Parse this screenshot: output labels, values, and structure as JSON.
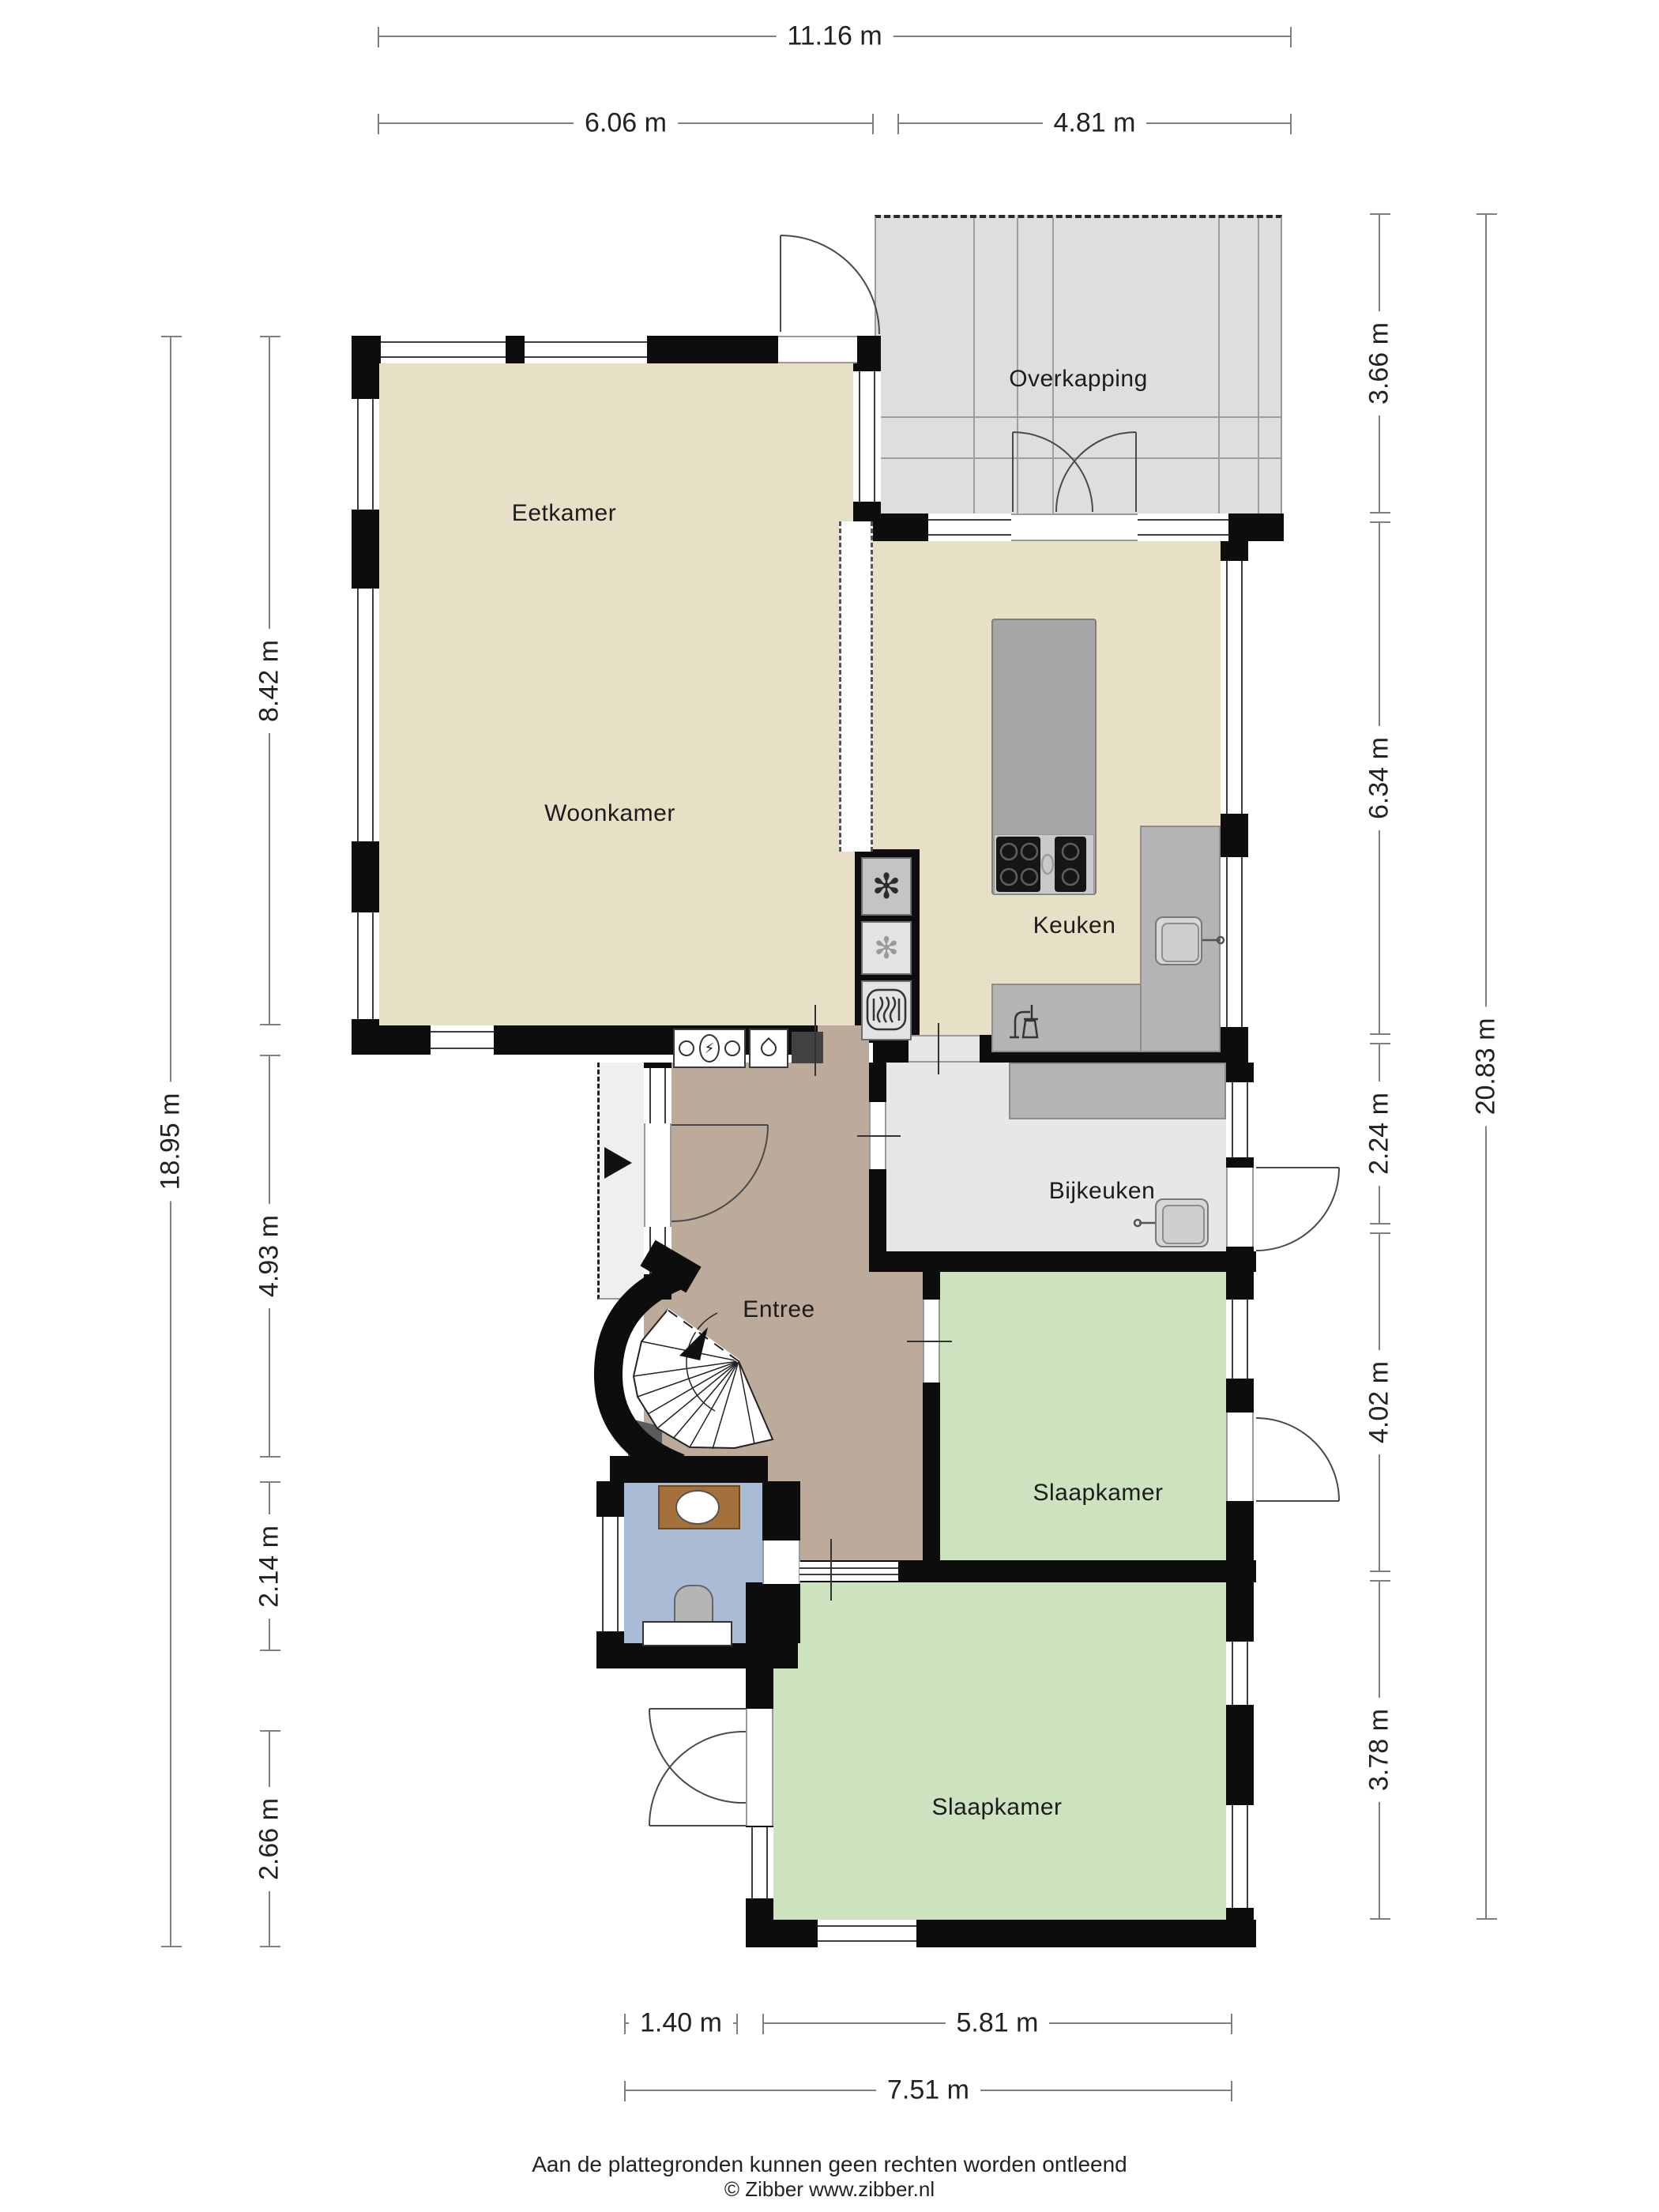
{
  "rooms": {
    "eetkamer": "Eetkamer",
    "woonkamer": "Woonkamer",
    "overkapping": "Overkapping",
    "keuken": "Keuken",
    "bijkeuken": "Bijkeuken",
    "entree": "Entree",
    "slaapkamer_1": "Slaapkamer",
    "slaapkamer_2": "Slaapkamer"
  },
  "dimensions": {
    "top_total": "11.16 m",
    "top_left": "6.06 m",
    "top_right": "4.81 m",
    "left_total": "18.95 m",
    "left_upper": "8.42 m",
    "left_mid": "4.93 m",
    "left_lower": "2.14 m",
    "left_bottom": "2.66 m",
    "right_total": "20.83 m",
    "right_overkapping": "3.66 m",
    "right_keuken": "6.34 m",
    "right_bijkeuken": "2.24 m",
    "right_slaapkamer1": "4.02 m",
    "right_slaapkamer2": "3.78 m",
    "bottom_left": "1.40 m",
    "bottom_right": "5.81 m",
    "bottom_total": "7.51 m"
  },
  "icons": {
    "freezer_glyph": "✻",
    "fridge_glyph": "✻",
    "electric_meter_glyph": "⚡"
  },
  "footer": {
    "disclaimer": "Aan de plattegronden kunnen geen rechten worden ontleend",
    "credit": "© Zibber www.zibber.nl"
  }
}
